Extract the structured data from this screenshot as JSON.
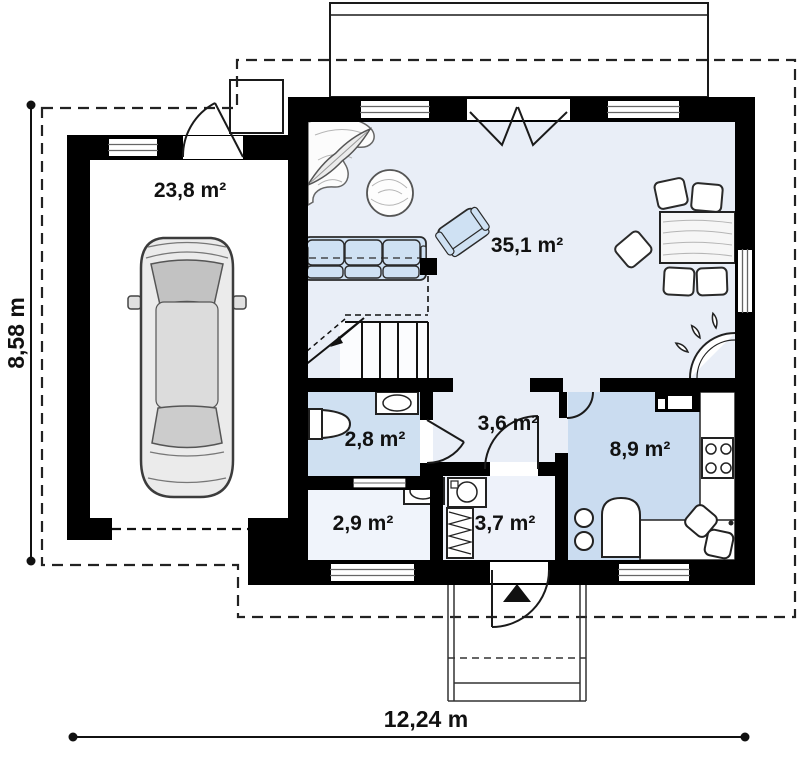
{
  "plan": {
    "type": "floor-plan",
    "rooms": [
      {
        "id": "garage",
        "label": "23,8 m²"
      },
      {
        "id": "living-room",
        "label": "35,1 m²"
      },
      {
        "id": "bathroom",
        "label": "2,8 m²"
      },
      {
        "id": "hallway",
        "label": "3,6 m²"
      },
      {
        "id": "kitchen",
        "label": "8,9 m²"
      },
      {
        "id": "storage",
        "label": "2,9 m²"
      },
      {
        "id": "entry",
        "label": "3,7 m²"
      }
    ],
    "dimensions": {
      "width_label": "12,24 m",
      "height_label": "8,58 m"
    },
    "colors": {
      "wall": "#000000",
      "floor_light": "#e9eef7",
      "floor_bathroom": "#cfe0f1",
      "floor_kitchen": "#cadcf0",
      "floor_pale": "#f0f4fb",
      "furniture_blue": "#cfe1f3",
      "background": "#ffffff"
    }
  }
}
